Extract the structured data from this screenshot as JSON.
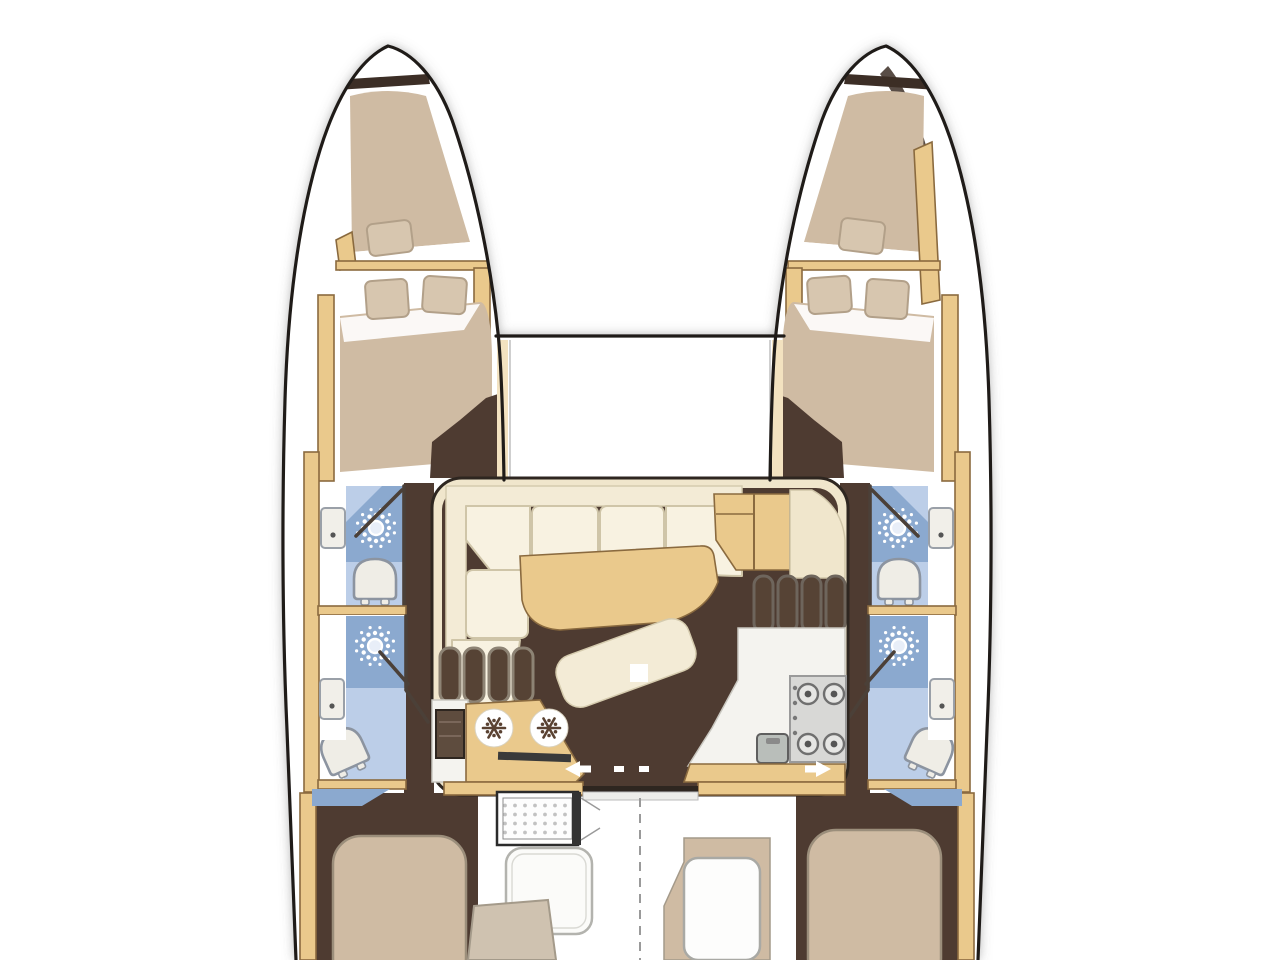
{
  "diagram": {
    "type": "boat-floor-plan",
    "vessel": "sailing-catamaran-top-view",
    "hulls": 2,
    "cabins": {
      "forepeak_berths": 2,
      "forward_double_berths": 2,
      "aft_island_berths": 2,
      "pillows_forward_each": 2,
      "pillows_forepeak_each": 1
    },
    "bathrooms": {
      "count": 4,
      "fixtures_each": [
        "shower",
        "toilet",
        "sink"
      ]
    },
    "salon": {
      "furniture": [
        "l-shaped-sofa",
        "dining-table",
        "chaise-bench",
        "nav-seat",
        "galley-counter",
        "cold-storage-counter"
      ],
      "companionway_steps_per_hull": 4
    },
    "galley": {
      "stove_burners": 4,
      "cold_drawer_circles": 2,
      "sink": 1
    },
    "cockpit": {
      "items": [
        "folding-table",
        "bench",
        "seat-cushion",
        "aft-seat-module"
      ],
      "centerline": "dashed"
    },
    "entry_door": {
      "type": "sliding",
      "arrow_direction": "left-right",
      "dashes": 2
    }
  },
  "colors": {
    "outline": "#1f1b18",
    "wall": "#4b4038",
    "floor": "#4e3b31",
    "floor_deep": "#3c2e26",
    "bed": "#cfbba3",
    "pillow": "#d7c6af",
    "pillow_edge": "#b2a089",
    "sofa": "#f3ebd6",
    "sofa_edge": "#d5cbae",
    "cushion": "#f8f2e1",
    "cushion_edge": "#cfc5a8",
    "band": "#f0e6cc",
    "wood": "#eac98c",
    "wood_edge": "#8a6a3f",
    "table_edge": "#45311f",
    "blue_mid": "#8ba9cf",
    "blue_light": "#bccee8",
    "fixture": "#efede6",
    "fixture_edge": "#8c94a0",
    "galley": "#f4f3ef",
    "steel": "#d8d8d6",
    "steel_edge": "#9a9a9a",
    "dark_slot": "#3a3a3a",
    "step_fill": "#564335",
    "step_edge_l": "#8d8374",
    "step_edge_r": "#6e655c",
    "arrow": "#ffffff",
    "snowflake": "#5a4232"
  }
}
